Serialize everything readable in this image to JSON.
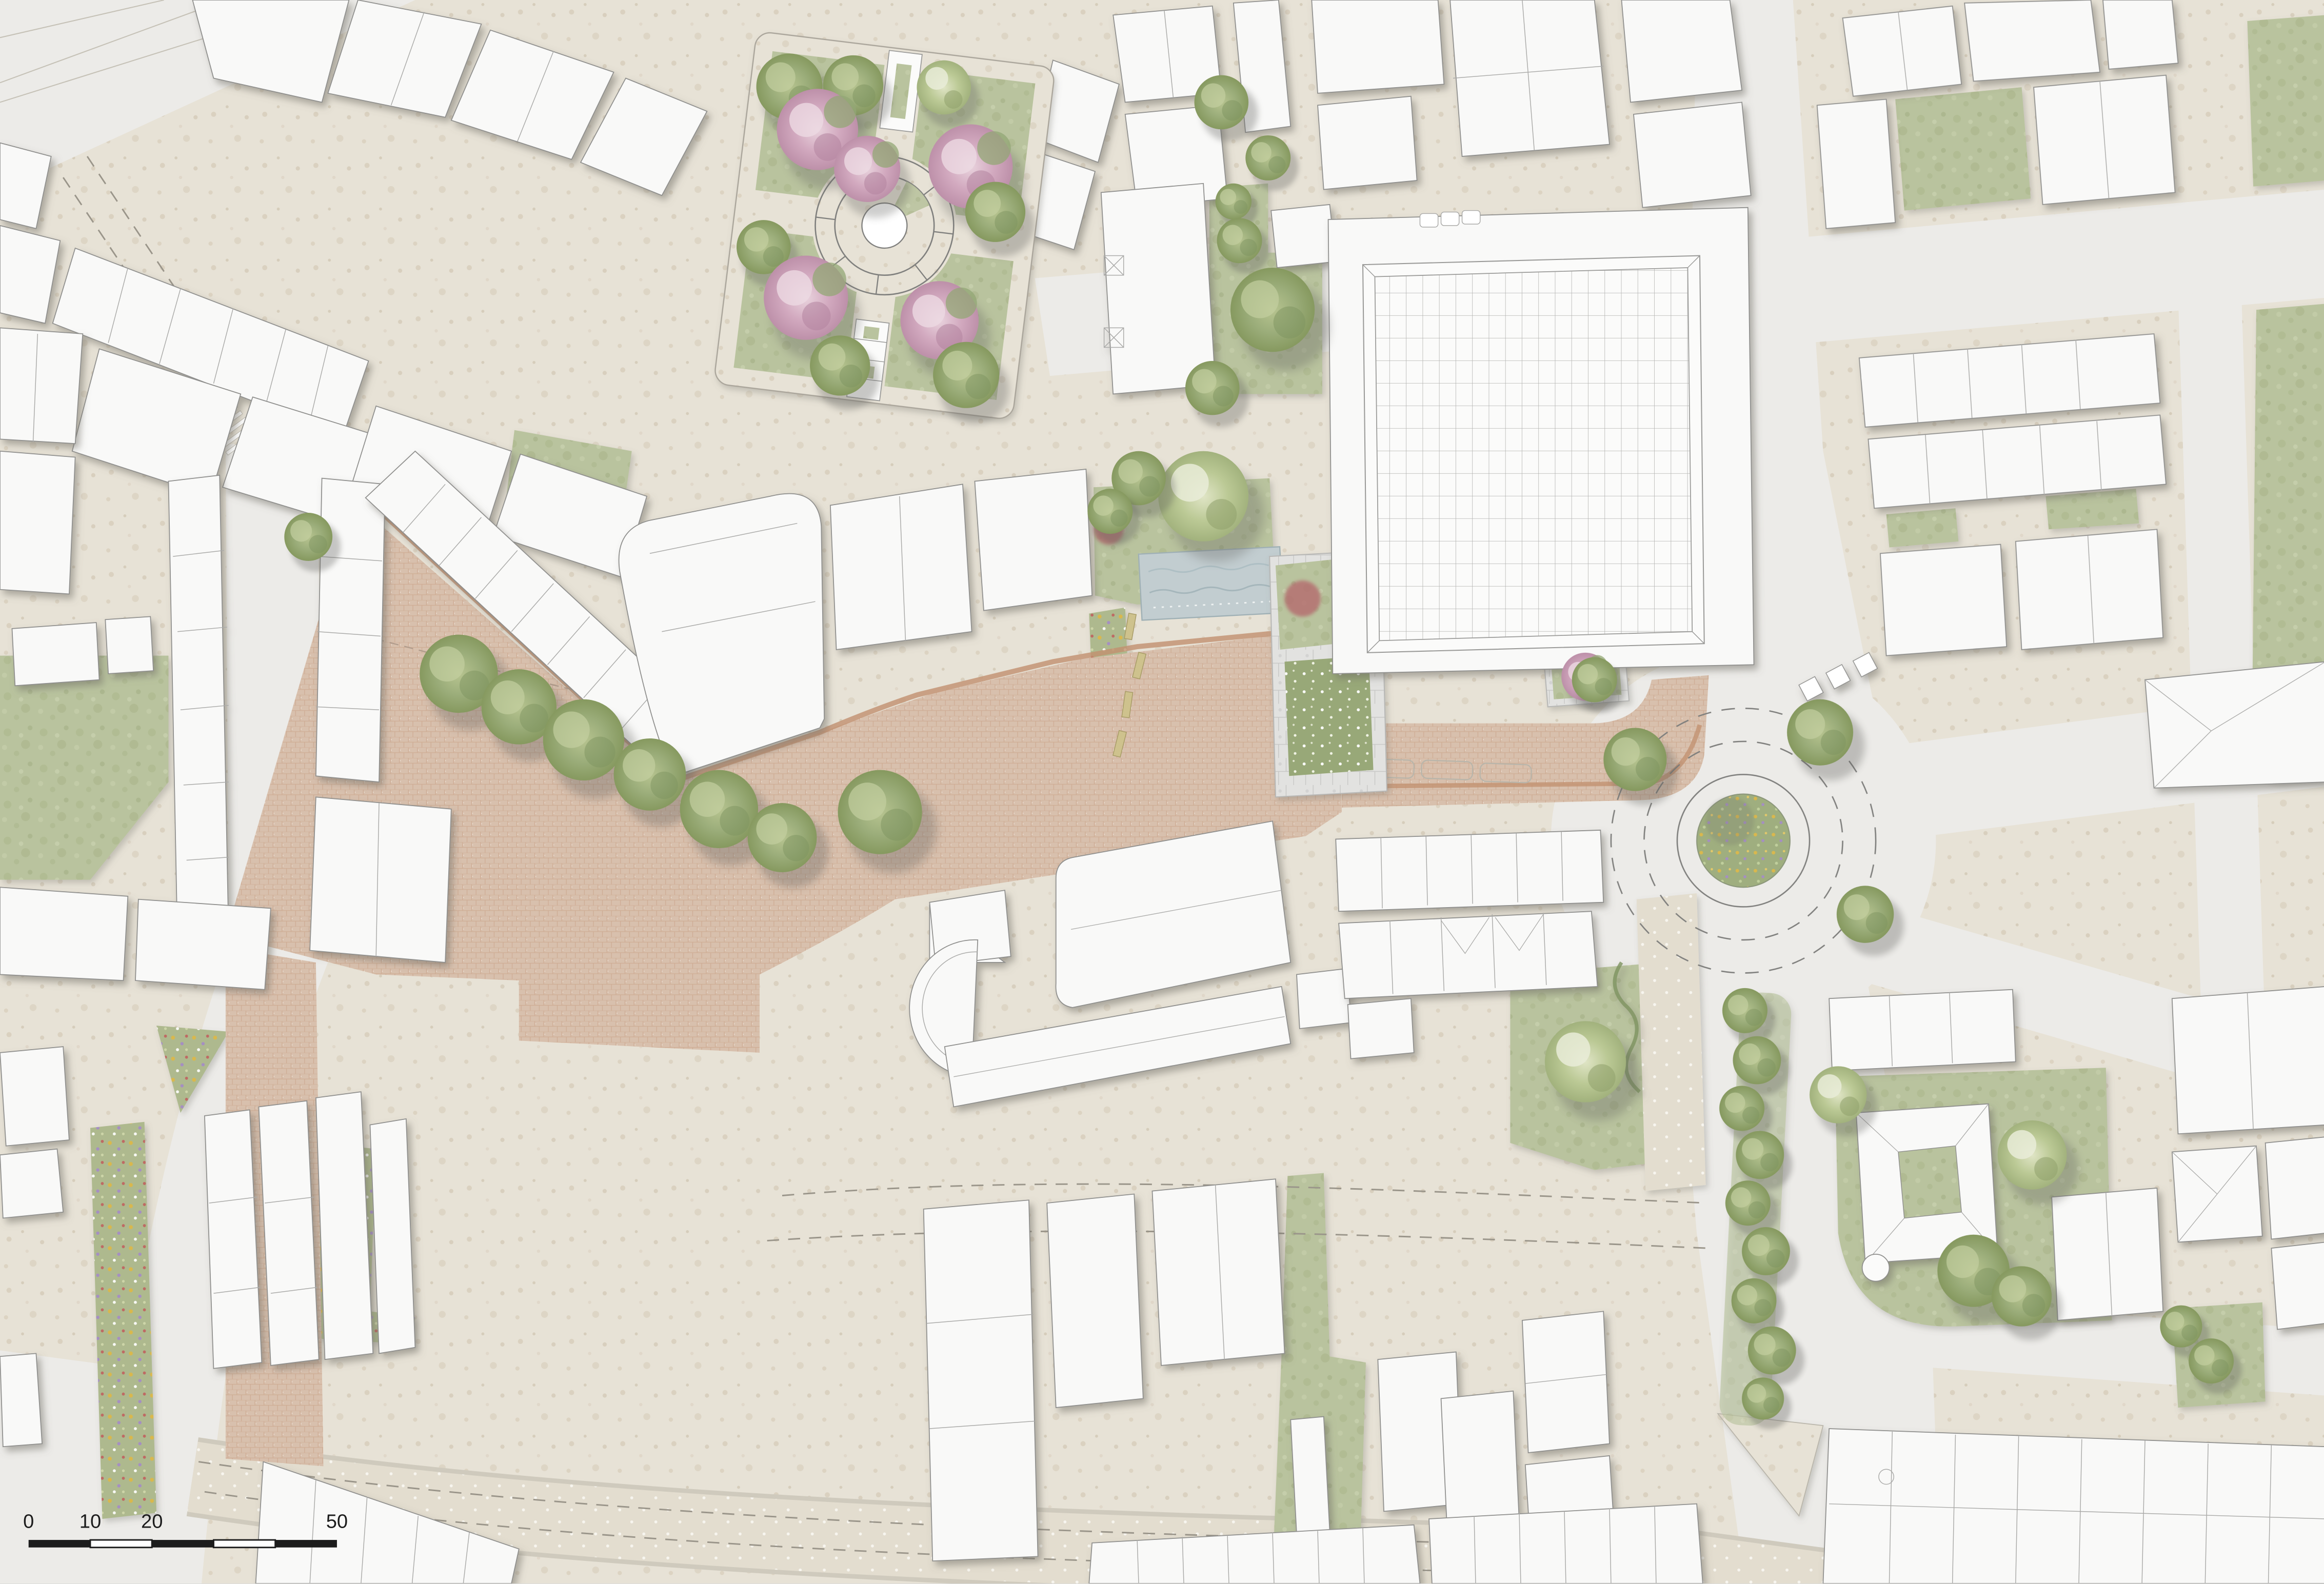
{
  "map": {
    "kind": "architectural-site-plan",
    "scale_bar": {
      "labels": [
        "0",
        "10",
        "20",
        "50"
      ],
      "segments": 5
    },
    "features": {
      "garden_square": "garden square with blossom trees and circular fountain path",
      "market_hall": "market hall with gridded glass roof",
      "central_plaza": "brick-paved pedestrian plaza with tree row, water basin, benches and planter courts",
      "church": "church with apse",
      "roundabout": "roundabout with planted wildflower centre island",
      "street_trees": "street tree row south of roundabout",
      "castle_court": "courtyard building with round tower on green",
      "flower_beds": "perennial flower beds along south-west street",
      "crosswalk": "pedestrian crossing",
      "parking_bays": "parking bay markings on plaza edge"
    }
  },
  "palette": {
    "paper": "#edece8",
    "sidewalk": "#e7e2d6",
    "road": "#ecebe8",
    "building": "#f9f9f8",
    "bstroke": "#8f8f8d",
    "green": "#b9c39e",
    "plaza": "#d8c0ad",
    "brickjoint": "#c79a7f",
    "brickdark": "#c2906f",
    "water": "#c2cdd0",
    "bench": "#cec28d",
    "flower_yellow": "#d9b84e",
    "flower_purple": "#a58fc2",
    "flower_red": "#c0625f",
    "ink": "#1c1c1c"
  }
}
